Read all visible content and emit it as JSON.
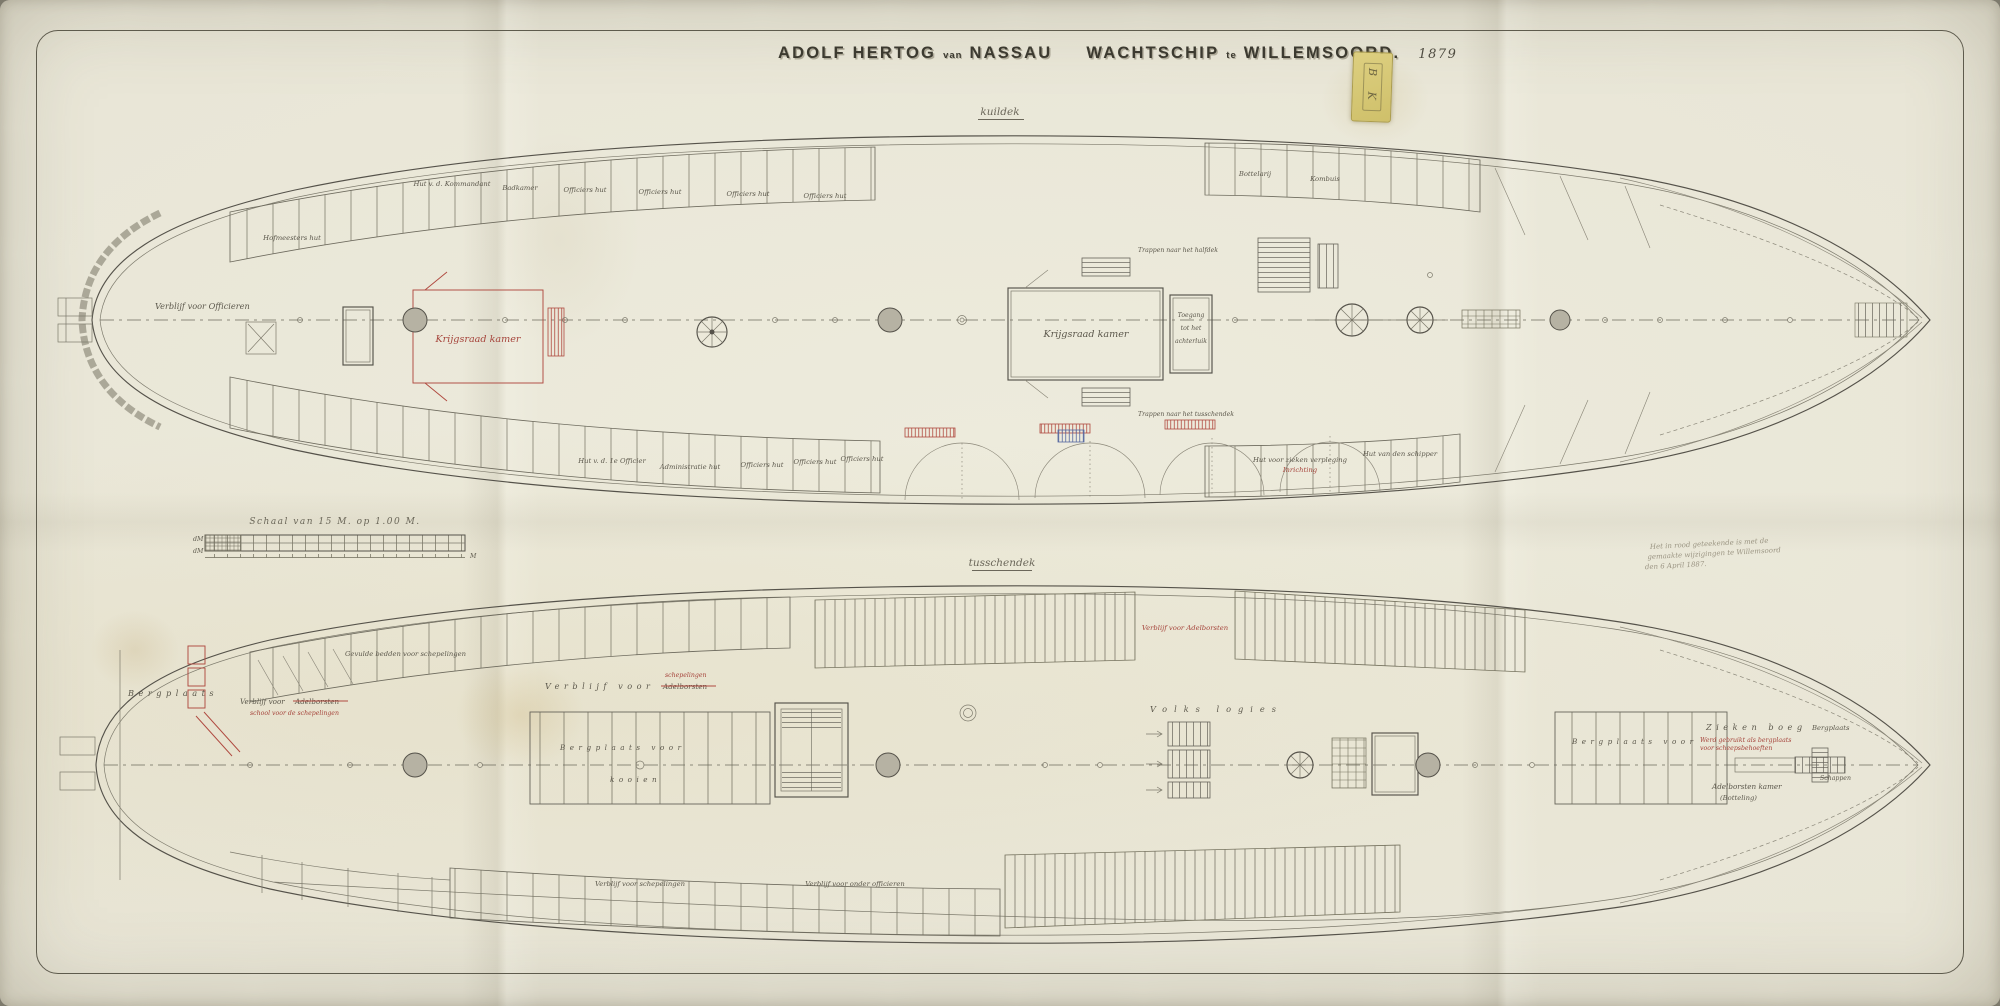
{
  "title": {
    "name1": "ADOLF HERTOG",
    "conn1": "van",
    "name2": "NASSAU",
    "type": "WACHTSCHIP",
    "conn2": "te",
    "place": "WILLEMSOORD.",
    "year": "1879"
  },
  "sticker": {
    "text": "B K"
  },
  "decks": {
    "kuildek": {
      "deck_label": "kuildek",
      "verblijf_officieren": "Verblijf voor Officieren",
      "hofmeesters_hut": "Hofmeesters hut",
      "hut_kommandant": "Hut v. d. Kommandant",
      "badkamer": "Badkamer",
      "officiers_hut": "Officiers hut",
      "krijgsraad_kamer": "Krijgsraad kamer",
      "toegang_1": "Toegang",
      "toegang_2": "tot het",
      "toegang_3": "achterluik",
      "trap_halfdek": "Trappen naar het halfdek",
      "trap_tusschendek": "Trappen naar het tusschendek",
      "hut_1e_officier": "Hut v. d. 1e Officier",
      "administratie_hut": "Administratie hut",
      "hut_zieken": "Hut voor zieken verpleging",
      "inrichting": "Inrichting",
      "hut_schipper": "Hut van den schipper",
      "bottelarij": "Bottelarij",
      "kombuis": "Kombuis"
    },
    "tusschendek": {
      "deck_label": "tusschendek",
      "bergplaats_stern": "Bergplaats",
      "verblijf_voor": "Verblijf voor",
      "adelborsten": "Adelborsten",
      "school_schepelingen": "school voor de schepelingen",
      "schepelingen_red": "schepelingen",
      "gevulde_bedden": "Gevulde bedden voor schepelingen",
      "verblijf_label": "Verblijf voor",
      "bergplaats_kooien": "Bergplaats voor",
      "kooien": "kooien",
      "volks_logies": "Volks logies",
      "verblijf_adelborsten": "Verblijf voor Adelborsten",
      "bergplaats_voor": "Bergplaats voor",
      "ziekenboeg": "Zieken boeg",
      "red_note_1": "Werd gebruikt als bergplaats",
      "red_note_2": "voor scheepsbehoeften",
      "bergplaats_bow": "Bergplaats",
      "adelborsten_kamer": "Adelborsten kamer",
      "botteling": "(Botteling)",
      "schappen": "Schappen",
      "verblijf_onderofficieren": "Verblijf voor onder officieren",
      "verblijf_schepelingen": "Verblijf voor schepelingen"
    }
  },
  "scale": {
    "label": "Schaal van 15 M. op 1.00 M.",
    "unit_left_top": "dM",
    "unit_left_bottom": "dM",
    "unit_right": "M"
  },
  "note": {
    "line1": "Het in rood geteekende is met de",
    "line2": "gemaakte wijzigingen te Willemsoord",
    "line3": "den 6 April 1887."
  }
}
